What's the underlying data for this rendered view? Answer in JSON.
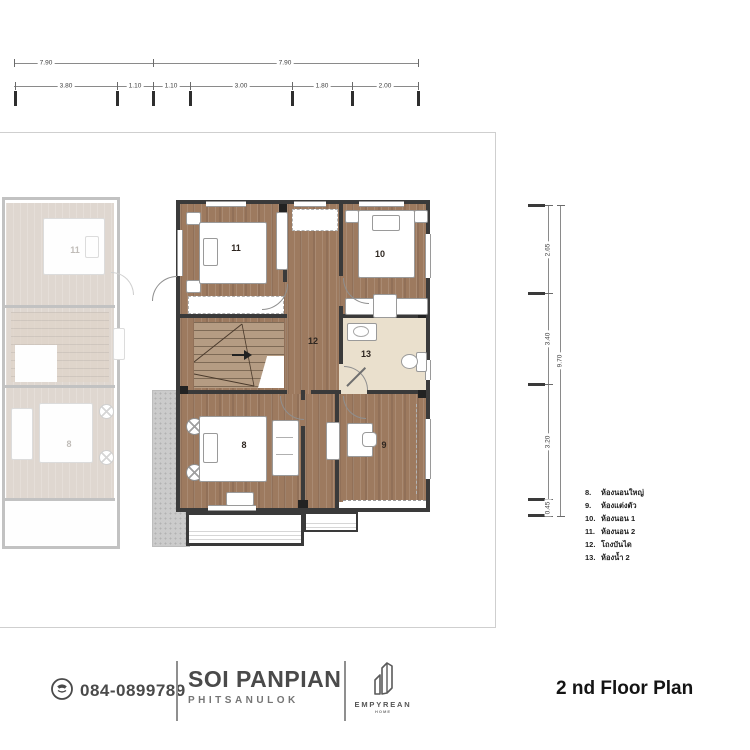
{
  "top_dimensions": {
    "overall": [
      "7.90",
      "7.90"
    ],
    "segments": [
      "3.80",
      "1.10",
      "1.10",
      "3.00",
      "1.80",
      "2.00"
    ]
  },
  "right_dimensions": {
    "segments": [
      "2.65",
      "3.40",
      "3.20",
      "0.45"
    ],
    "overall": "9.70"
  },
  "plan": {
    "rooms": {
      "r8": "8",
      "r9": "9",
      "r10": "10",
      "r11": "11",
      "r12": "12",
      "r13": "13"
    },
    "ghost_rooms": {
      "r11": "11",
      "r8": "8"
    }
  },
  "legend": {
    "items": [
      {
        "num": "8.",
        "label": "ห้องนอนใหญ่"
      },
      {
        "num": "9.",
        "label": "ห้องแต่งตัว"
      },
      {
        "num": "10.",
        "label": "ห้องนอน 1"
      },
      {
        "num": "11.",
        "label": "ห้องนอน 2"
      },
      {
        "num": "12.",
        "label": "โถงบันได"
      },
      {
        "num": "13.",
        "label": "ห้องน้ำ 2"
      }
    ]
  },
  "footer": {
    "phone": "084-0899789",
    "project_name": "SOI PANPIAN",
    "project_location": "PHITSANULOK",
    "brand_name": "EMPYREAN",
    "brand_sub": "HOME",
    "plan_title": "2 nd Floor Plan"
  },
  "colors": {
    "wood": "#9d7a5f",
    "bath_floor": "#eae0cd",
    "wall": "#3a3a3a",
    "footer_text": "#4a4a4a"
  }
}
